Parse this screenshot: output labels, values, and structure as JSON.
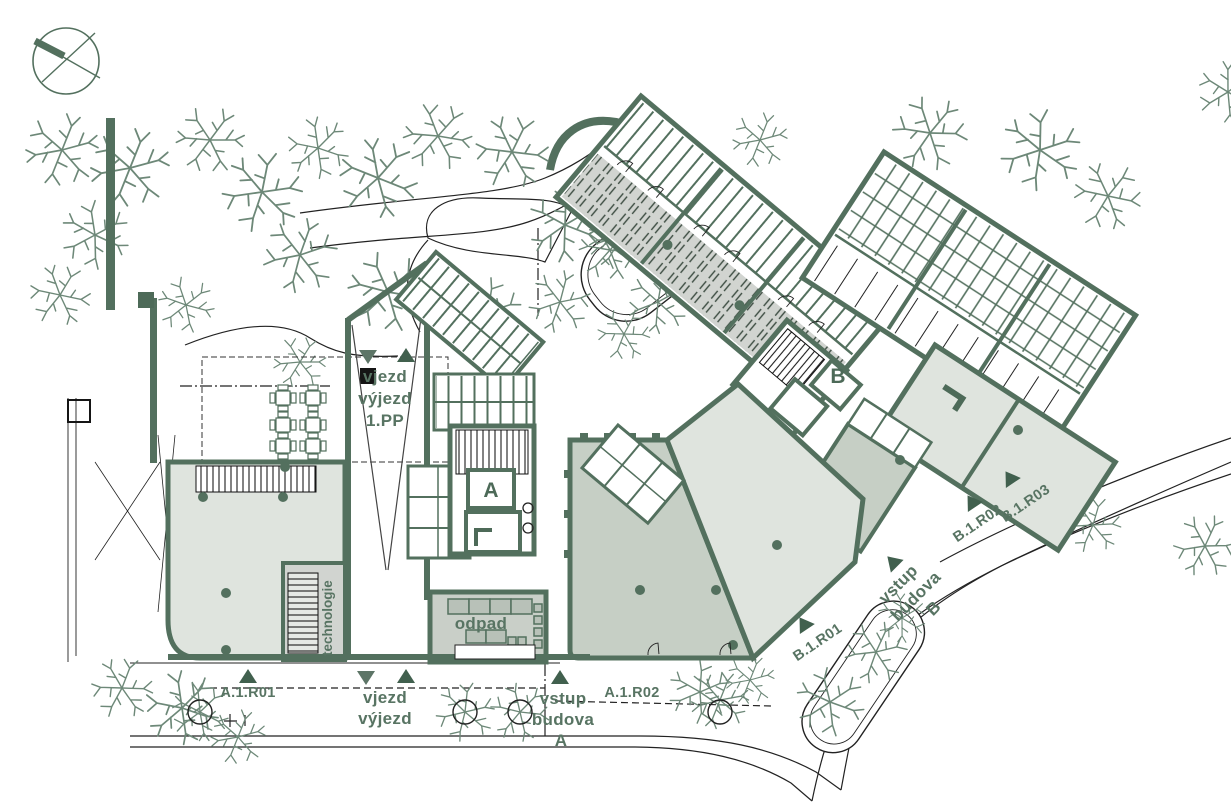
{
  "colors": {
    "line_green": "#53705e",
    "wall_green": "#4d6a58",
    "text_green": "#587463",
    "marker_green": "#41604e",
    "fill_light": "#dfe4de",
    "fill_mid": "#c6cfc5",
    "corridor_gray": "#d1d4d0",
    "tree_green": "#6d8878",
    "black_line": "#222222"
  },
  "labels": {
    "ramp_main": {
      "lines": [
        "vjezd",
        "výjezd",
        "1.PP"
      ]
    },
    "ramp_street": {
      "lines": [
        "vjezd",
        "výjezd"
      ]
    },
    "entrance_a": {
      "lines": [
        "vstup",
        "budova",
        "A"
      ]
    },
    "entrance_b": {
      "lines": [
        "vstup",
        "budova",
        "B"
      ]
    },
    "core_a": "A",
    "core_b": "B",
    "room_odpad": "odpad",
    "room_technologie": "technologie",
    "unit_a1r01": "A.1.R01",
    "unit_a1r02": "A.1.R02",
    "unit_b1r01": "B.1.R01",
    "unit_b1r02": "B.1.R02",
    "unit_b1r03": "B.1.R03"
  }
}
